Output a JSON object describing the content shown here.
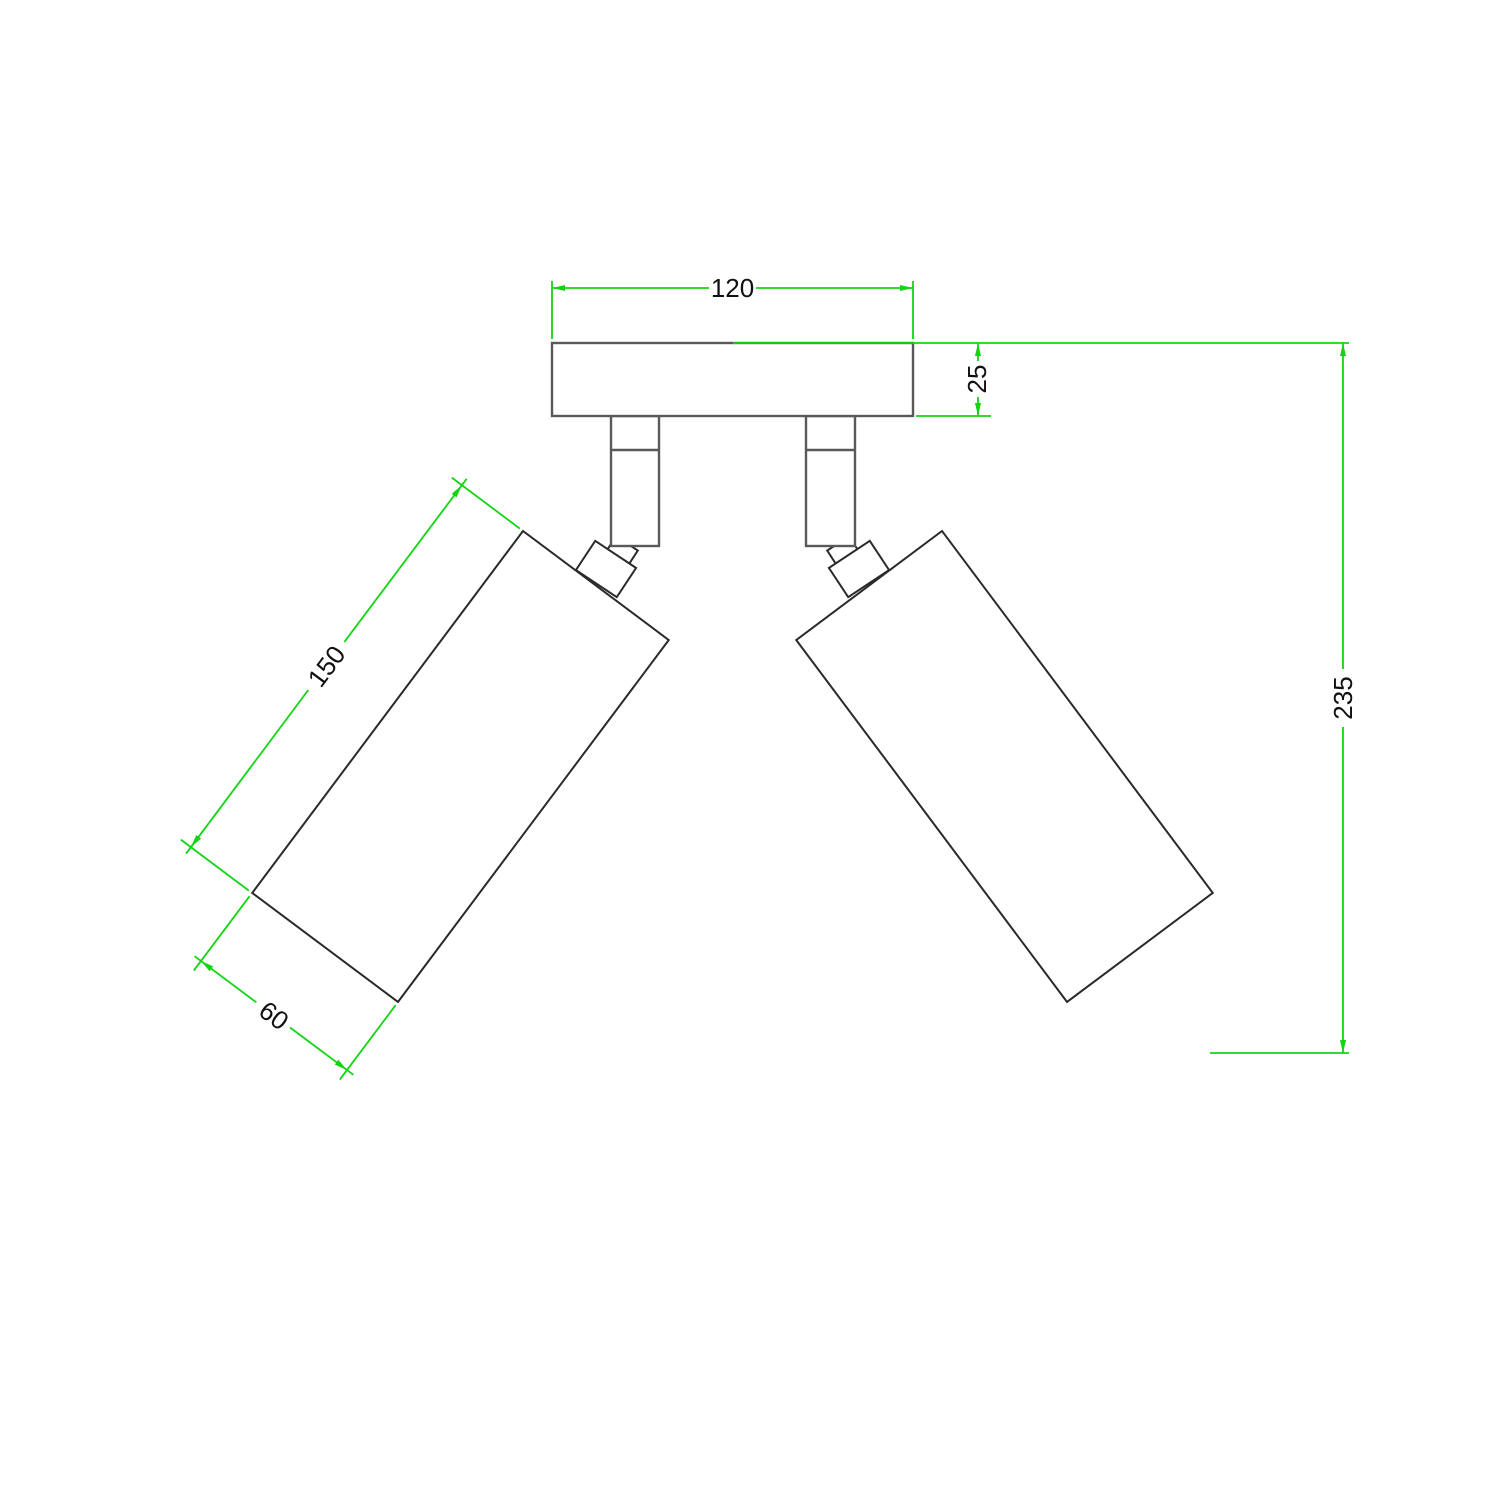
{
  "drawing": {
    "background": "#ffffff",
    "colors": {
      "dimension_lines": "#12d412",
      "fixture_outline": "#595959",
      "fixture_outline_dark": "#2a2a2a",
      "label_text": "#111111"
    },
    "dimensions": {
      "canopy_width": {
        "label": "120",
        "value": 120
      },
      "canopy_height": {
        "label": "25",
        "value": 25
      },
      "overall_height": {
        "label": "235",
        "value": 235
      },
      "spot_length": {
        "label": "150",
        "value": 150
      },
      "spot_diameter": {
        "label": "60",
        "value": 60
      }
    }
  }
}
